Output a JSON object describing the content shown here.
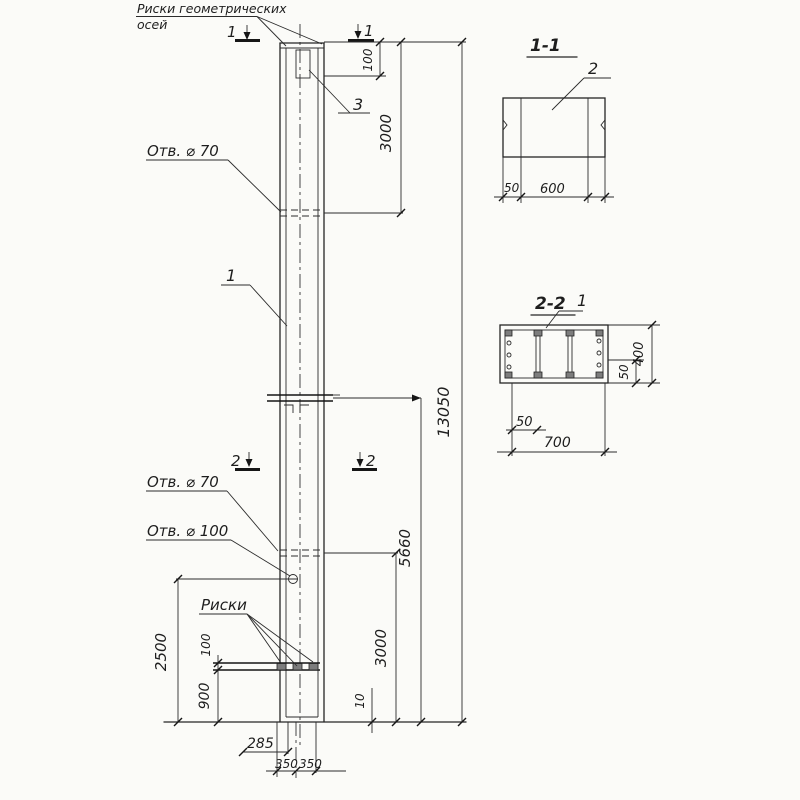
{
  "drawing": {
    "paper_color": "#fbfbf8",
    "ink_color": "#1e1e1e",
    "callouts": {
      "geo_axes_line1": "Риски геометрических",
      "geo_axes_line2": "осей",
      "hole70_upper": "Отв. ⌀ 70",
      "hole70_lower": "Отв. ⌀ 70",
      "hole100": "Отв. ⌀ 100",
      "riski": "Риски",
      "part_1": "1",
      "part_3": "3"
    },
    "section_markers": {
      "s1_left": "1",
      "s1_right": "1",
      "s2_left": "2",
      "s2_right": "2"
    },
    "dims_main": {
      "top_offset": "100",
      "top_span": "3000",
      "total_height": "13050",
      "lower_span": "5660",
      "bottom_span": "3000",
      "base_thick": "10",
      "left_total": "2500",
      "bar_offset": "100",
      "bar_to_base": "900",
      "off_left": "285",
      "half_left": "350",
      "half_right": "350"
    },
    "section_1_1": {
      "title": "1-1",
      "part_label": "2",
      "dim_wall": "50",
      "dim_width": "600"
    },
    "section_2_2": {
      "title": "2-2",
      "part_label": "1",
      "dim_wall_right": "50",
      "dim_height": "400",
      "dim_wall_bottom": "50",
      "dim_width": "700"
    }
  }
}
